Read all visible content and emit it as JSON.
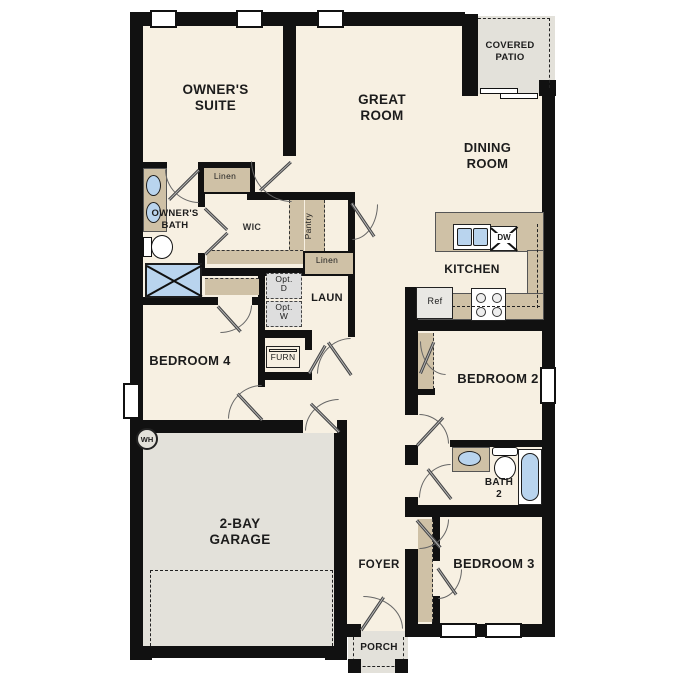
{
  "floor_plan": {
    "title": "single-story house floor plan",
    "rooms": {
      "owners_suite": "OWNER'S\nSUITE",
      "great_room": "GREAT\nROOM",
      "covered_patio": "COVERED\nPATIO",
      "dining_room": "DINING\nROOM",
      "owners_bath": "OWNER'S\nBATH",
      "wic": "WIC",
      "kitchen": "KITCHEN",
      "laundry": "LAUN",
      "bedroom_4": "BEDROOM 4",
      "bedroom_2": "BEDROOM 2",
      "bath_2": "BATH\n2",
      "bedroom_3": "BEDROOM 3",
      "garage": "2-BAY\nGARAGE",
      "foyer": "FOYER",
      "porch": "PORCH"
    },
    "closets": {
      "linen_upper": "Linen",
      "pantry": "Pantry",
      "linen_lower": "Linen"
    },
    "appliances": {
      "dishwasher": "DW",
      "refrigerator": "Ref",
      "furnace": "FURN",
      "water_heater": "WH",
      "optional_dryer": "Opt.\nD",
      "optional_washer": "Opt.\nW"
    },
    "colors": {
      "floor_cream": "#f7f0e2",
      "outdoor_gray": "#e3e1da",
      "cabinet_tan": "#cfc1a6",
      "wall_black": "#111111",
      "fixture_blue": "#b9d4ee"
    }
  }
}
